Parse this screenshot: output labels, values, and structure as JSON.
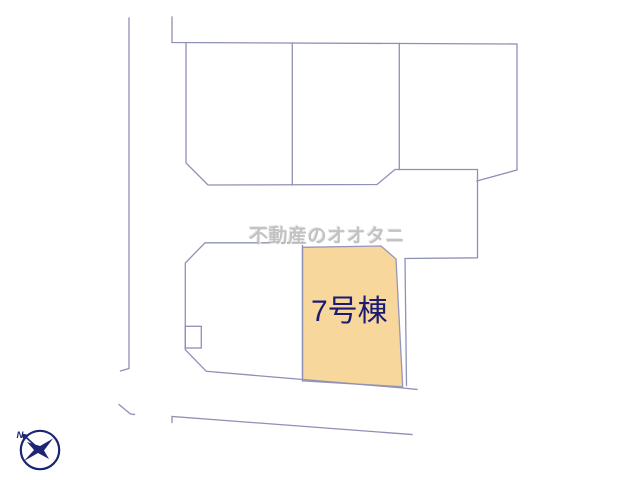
{
  "canvas": {
    "width": 640,
    "height": 480,
    "background": "#ffffff"
  },
  "colors": {
    "parcel_line": "#8e90b5",
    "highlight_fill": "#f8d79d",
    "highlight_line": "#9496ba",
    "label_text": "#1b1b72",
    "watermark_text": "#b8b8b8",
    "compass": "#1c2672"
  },
  "labels": {
    "watermark": "不動産のオオタニ",
    "highlighted_plot": "7号棟",
    "compass_north": "N"
  }
}
